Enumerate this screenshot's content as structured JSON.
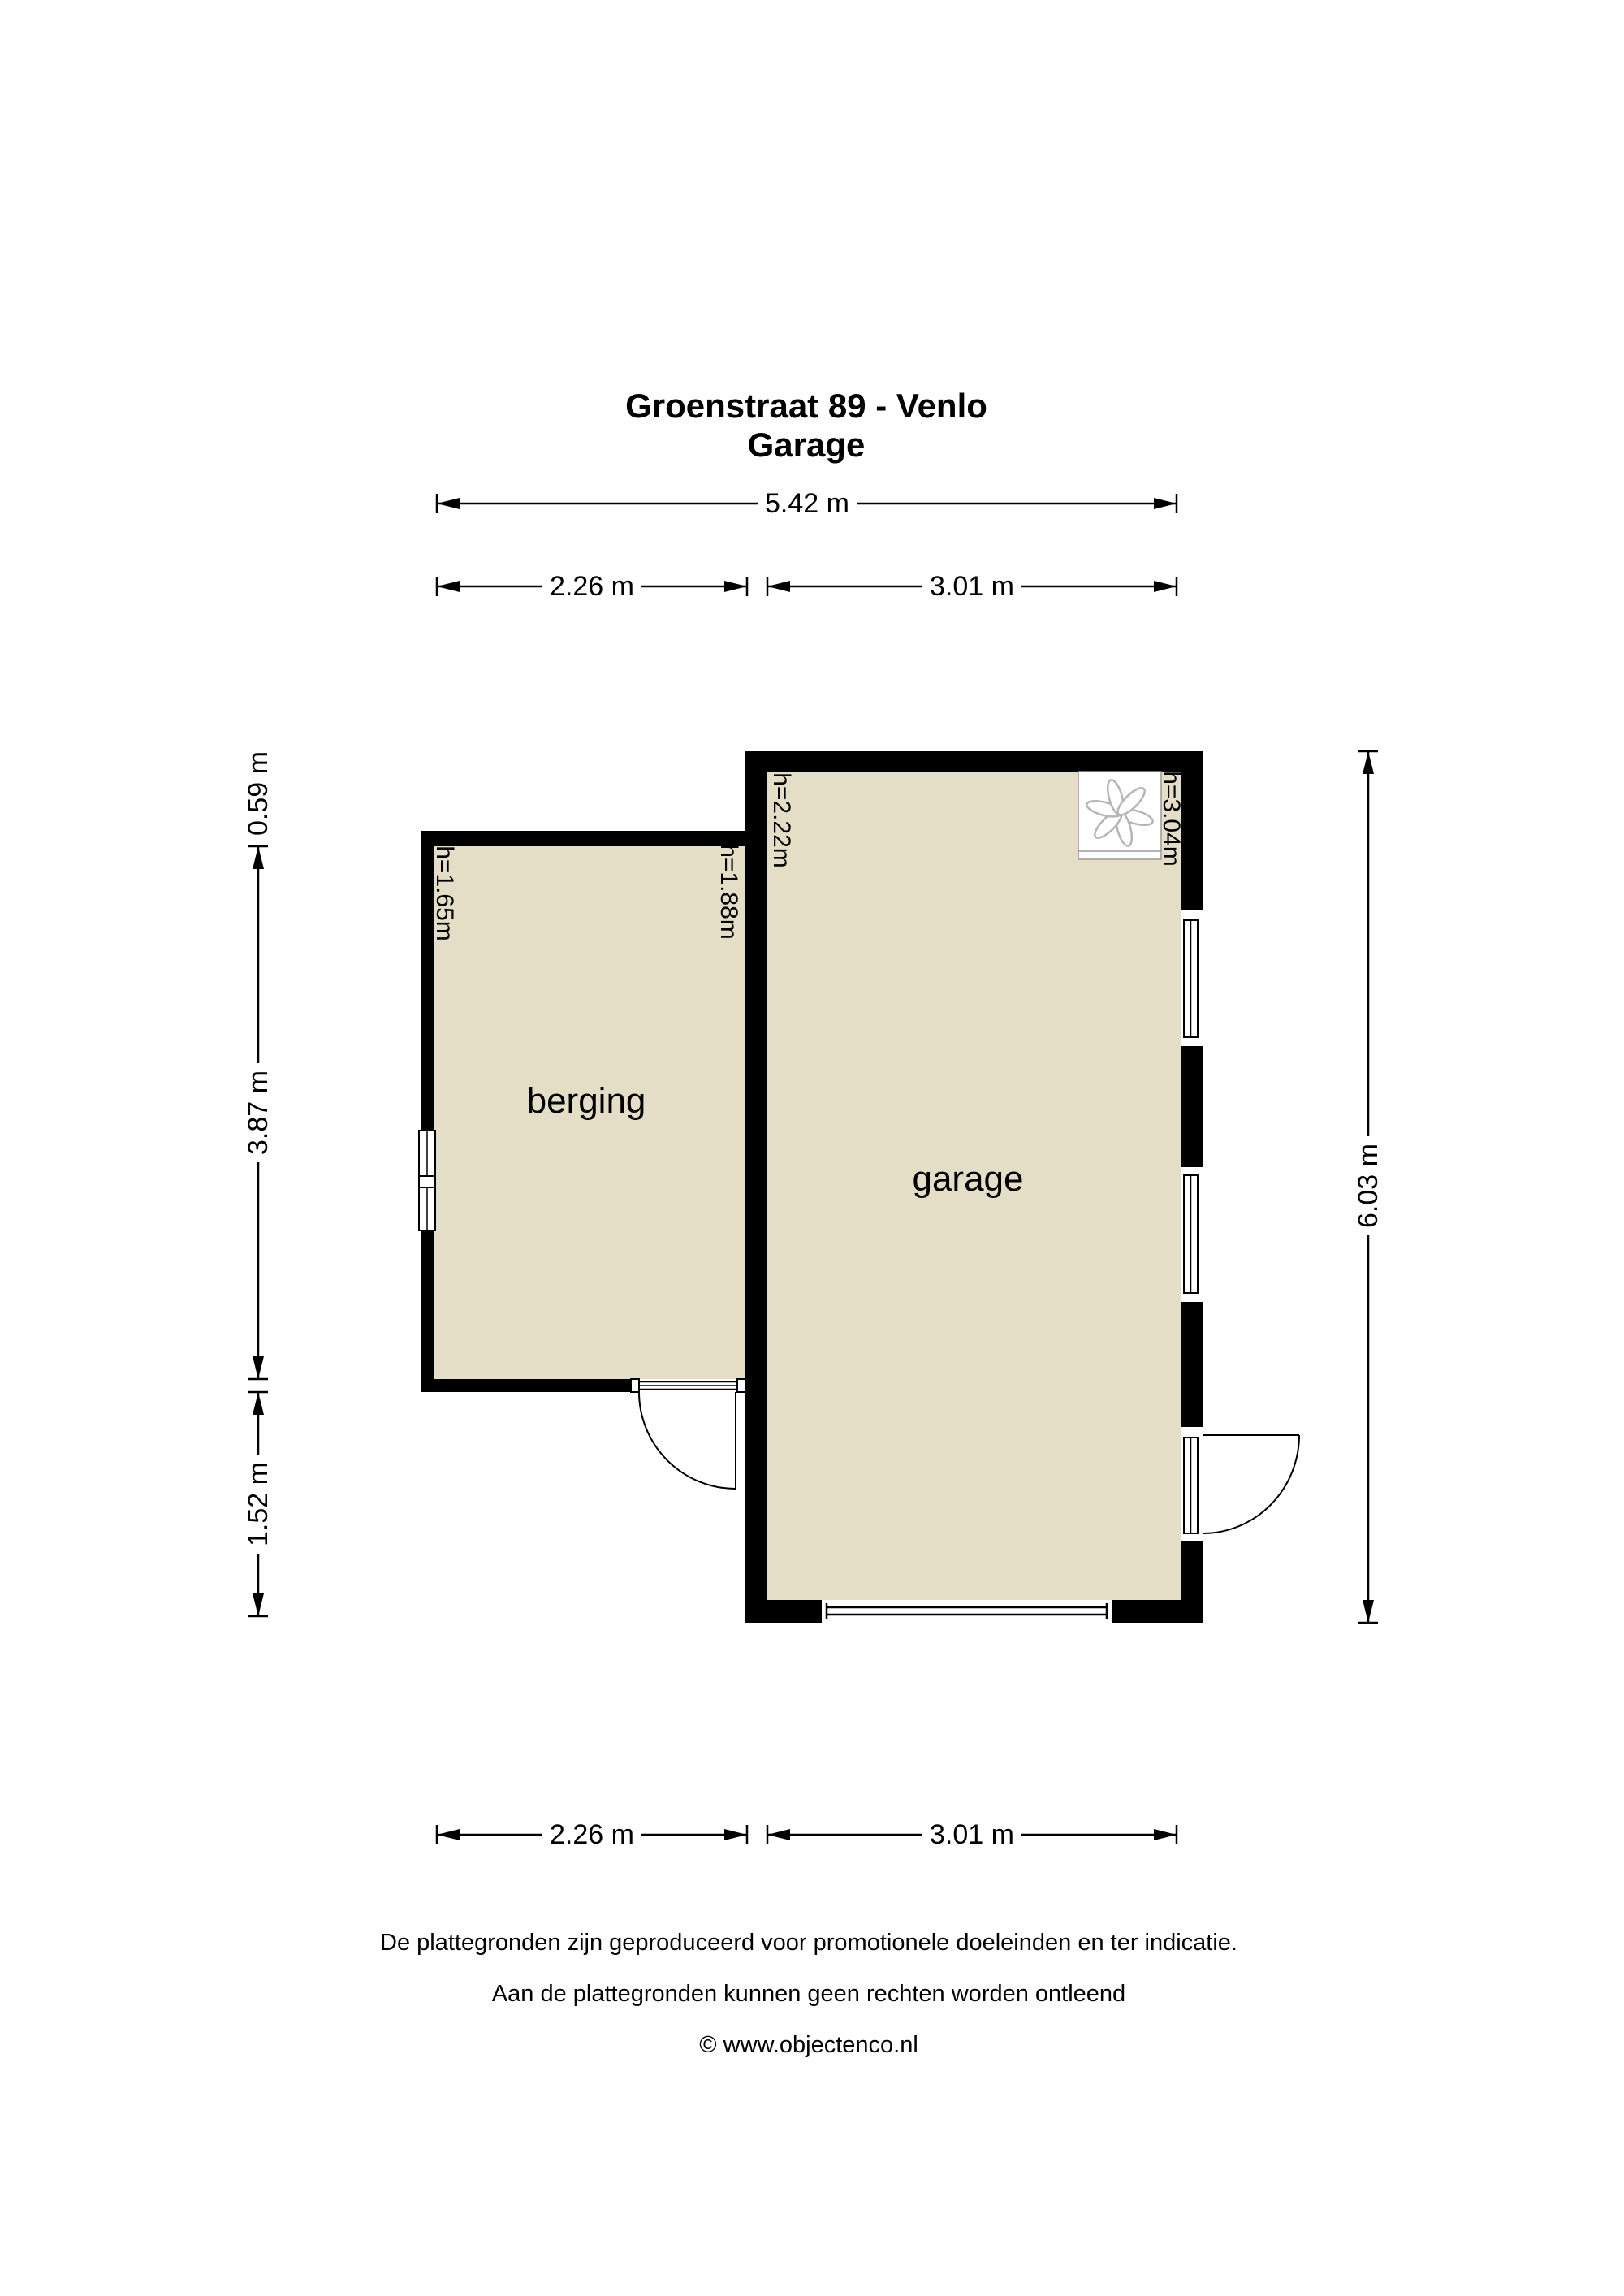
{
  "title": {
    "line1": "Groenstraat 89 - Venlo",
    "line2": "Garage"
  },
  "dims": {
    "top_total": "5.42 m",
    "top_left": "2.26 m",
    "top_right": "3.01 m",
    "bottom_left": "2.26 m",
    "bottom_right": "3.01 m",
    "left_top": "0.59 m",
    "left_mid": "3.87 m",
    "left_bottom": "1.52 m",
    "right_total": "6.03 m"
  },
  "rooms": {
    "berging": {
      "label": "berging",
      "height_left": "h=1.65m",
      "height_right": "h=1.88m"
    },
    "garage": {
      "label": "garage",
      "height_left": "h=2.22m",
      "height_right": "h=3.04m"
    }
  },
  "icons": {
    "fan": "ventilation-fan"
  },
  "colors": {
    "floor": "#e4dec7",
    "wall": "#000000",
    "line": "#000000",
    "fan_stroke": "#b5b5b5",
    "fan_box_border": "#999999"
  },
  "footer": {
    "line1": "De plattegronden zijn geproduceerd voor promotionele doeleinden en ter indicatie.",
    "line2": "Aan de plattegronden kunnen geen rechten worden ontleend",
    "line3": "© www.objectenco.nl"
  }
}
